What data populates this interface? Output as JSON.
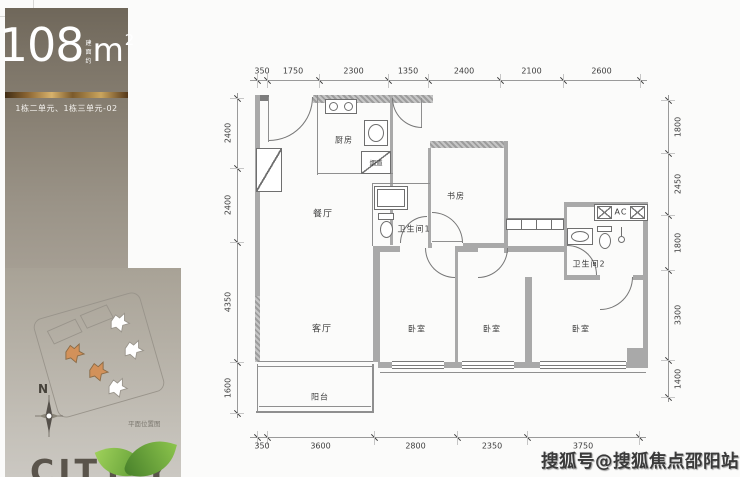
{
  "sidebar": {
    "area_number": "108",
    "area_prefix": "建面约",
    "area_unit": "m",
    "area_sup": "2",
    "unit_text": "1栋二单元、1栋三单元-02",
    "compass_label": "N",
    "site_caption": "平面位置图",
    "brand_text": "CITY Y",
    "accent_gold": "#caa55e",
    "leaf_green": "#6aa84f"
  },
  "watermark": {
    "text": "搜狐号@搜狐焦点邵阳站"
  },
  "floorplan": {
    "rooms": [
      [
        "厨房",
        344,
        140,
        2,
        "room-label-kitchen"
      ],
      [
        "烟道",
        376,
        162,
        3,
        "room-label-flue"
      ],
      [
        "餐厅",
        323,
        213,
        1,
        "room-label-dining"
      ],
      [
        "卫生间1",
        414,
        229,
        2,
        "room-label-bathroom-1"
      ],
      [
        "书房",
        456,
        196,
        2,
        "room-label-study"
      ],
      [
        "AC",
        621,
        212,
        2,
        "room-label-ac"
      ],
      [
        "卫生间2",
        589,
        264,
        2,
        "room-label-bathroom-2"
      ],
      [
        "客厅",
        322,
        328,
        1,
        "room-label-living"
      ],
      [
        "卧室",
        417,
        329,
        2,
        "room-label-bedroom-1"
      ],
      [
        "卧室",
        492,
        329,
        2,
        "room-label-bedroom-2"
      ],
      [
        "卧室",
        581,
        329,
        2,
        "room-label-bedroom-3"
      ],
      [
        "阳台",
        320,
        397,
        2,
        "room-label-balcony"
      ]
    ],
    "walls": [
      [
        255,
        95,
        14,
        6,
        "d"
      ],
      [
        313,
        95,
        120,
        8,
        "h"
      ],
      [
        390,
        95,
        3,
        150,
        "g"
      ],
      [
        430,
        141,
        77,
        7,
        "h"
      ],
      [
        428,
        148,
        3,
        100,
        "g"
      ],
      [
        504,
        141,
        4,
        112,
        "g"
      ],
      [
        565,
        202,
        83,
        5,
        "g"
      ],
      [
        564,
        202,
        3,
        75,
        "g"
      ],
      [
        643,
        202,
        5,
        162,
        "g"
      ],
      [
        255,
        95,
        5,
        201,
        "g"
      ],
      [
        255,
        296,
        5,
        66,
        "h"
      ],
      [
        373,
        246,
        27,
        6,
        "g"
      ],
      [
        455,
        246,
        23,
        6,
        "g"
      ],
      [
        508,
        246,
        56,
        6,
        "g"
      ],
      [
        564,
        275,
        36,
        5,
        "g"
      ],
      [
        633,
        275,
        15,
        5,
        "g"
      ],
      [
        428,
        243,
        4,
        5,
        "g"
      ],
      [
        463,
        243,
        44,
        5,
        "g"
      ],
      [
        373,
        250,
        7,
        112,
        "g"
      ],
      [
        455,
        250,
        3,
        112,
        "g"
      ],
      [
        525,
        277,
        7,
        85,
        "g"
      ],
      [
        378,
        362,
        270,
        6,
        "g"
      ],
      [
        627,
        348,
        16,
        16,
        "g"
      ]
    ],
    "lines": [
      [
        317,
        95,
        1,
        80
      ],
      [
        317,
        173,
        76,
        1
      ],
      [
        372,
        183,
        58,
        1
      ],
      [
        372,
        183,
        1,
        63
      ],
      [
        506,
        218,
        58,
        1
      ],
      [
        258,
        361,
        115,
        1
      ],
      [
        258,
        366,
        115,
        1
      ],
      [
        257,
        364,
        1,
        49
      ],
      [
        372,
        364,
        2,
        49
      ],
      [
        256,
        411,
        118,
        2
      ],
      [
        259,
        406,
        112,
        1
      ],
      [
        380,
        372,
        266,
        1
      ],
      [
        268,
        97,
        1,
        45
      ],
      [
        421,
        98,
        1,
        30
      ],
      [
        432,
        241,
        30,
        1
      ]
    ],
    "windows": [
      [
        392,
        361,
        52,
        8
      ],
      [
        462,
        361,
        52,
        8
      ],
      [
        540,
        361,
        86,
        8
      ]
    ],
    "fixtures": [
      [
        "box",
        325,
        99,
        32,
        15,
        "stove"
      ],
      [
        "circ",
        329,
        102,
        9,
        9,
        "stove-burner"
      ],
      [
        "circ",
        344,
        102,
        9,
        9,
        "stove-burner"
      ],
      [
        "box",
        364,
        120,
        24,
        26,
        "kitchen-sink"
      ],
      [
        "oval",
        368,
        124,
        16,
        18,
        "kitchen-sink-basin"
      ],
      [
        "box",
        361,
        151,
        30,
        23,
        "flue-box"
      ],
      [
        "diag",
        361,
        151,
        30,
        23,
        "flue-diagonal"
      ],
      [
        "box",
        256,
        148,
        26,
        44,
        "entry-cabinet"
      ],
      [
        "diag",
        256,
        148,
        26,
        44,
        "entry-cabinet-diagonal"
      ],
      [
        "box",
        374,
        186,
        34,
        24,
        "bathtub"
      ],
      [
        "box",
        377,
        189,
        28,
        18,
        "bathtub-inner"
      ],
      [
        "box",
        378,
        213,
        16,
        7,
        "toilet-1-tank"
      ],
      [
        "oval",
        380,
        221,
        13,
        17,
        "toilet-1-bowl"
      ],
      [
        "box",
        506,
        219,
        58,
        11,
        "hall-closet"
      ],
      [
        "vl",
        521,
        219,
        1,
        11,
        "closet-divider"
      ],
      [
        "vl",
        536,
        219,
        1,
        11,
        "closet-divider"
      ],
      [
        "vl",
        551,
        219,
        1,
        11,
        "closet-divider"
      ],
      [
        "box",
        567,
        228,
        26,
        17,
        "vanity"
      ],
      [
        "oval",
        571,
        231,
        18,
        11,
        "vanity-basin"
      ],
      [
        "box",
        597,
        226,
        15,
        6,
        "toilet-2-tank"
      ],
      [
        "oval",
        599,
        233,
        12,
        16,
        "toilet-2-bowl"
      ],
      [
        "circ",
        618,
        236,
        7,
        7,
        "shower-head"
      ],
      [
        "vl",
        621,
        227,
        1,
        9,
        "shower-arm"
      ],
      [
        "box",
        594,
        204,
        54,
        17,
        "ac-box"
      ],
      [
        "xbox",
        597,
        206,
        15,
        13,
        "ac-hatch"
      ],
      [
        "xbox",
        630,
        206,
        15,
        13,
        "ac-hatch"
      ]
    ],
    "arcs": [
      [
        269,
        97,
        44,
        "br",
        "entry-door-arc"
      ],
      [
        392,
        98,
        30,
        "bl",
        "kitchen-door-arc"
      ],
      [
        432,
        212,
        31,
        "tr",
        "study-door-arc"
      ],
      [
        400,
        216,
        27,
        "tl",
        "bathroom-1-door-arc"
      ],
      [
        425,
        248,
        30,
        "bl",
        "bedroom-1-door-arc"
      ],
      [
        478,
        248,
        30,
        "br",
        "bedroom-2-door-arc"
      ],
      [
        600,
        277,
        33,
        "br",
        "bedroom-3-door-arc"
      ],
      [
        567,
        245,
        30,
        "tr",
        "bathroom-2-door-arc"
      ]
    ],
    "dims": {
      "top": {
        "line": [
          250,
          80,
          397
        ],
        "ticks": [
          257,
          267,
          319,
          388,
          428,
          500,
          563,
          640
        ],
        "values": [
          "350",
          "1750",
          "2300",
          "1350",
          "2400",
          "2100",
          "2600"
        ]
      },
      "bottom": {
        "line": [
          250,
          437,
          396
        ],
        "ticks": [
          257,
          267,
          374,
          457,
          527,
          639
        ],
        "values": [
          "350",
          "3600",
          "2800",
          "2350",
          "3750"
        ]
      },
      "left": {
        "line": [
          237,
          93,
          325
        ],
        "ticks": [
          98,
          168,
          242,
          362,
          413
        ],
        "values": [
          "2400",
          "2400",
          "4350",
          "1600"
        ]
      },
      "right": {
        "line": [
          668,
          95,
          307
        ],
        "ticks": [
          100,
          153,
          215,
          270,
          360,
          397
        ],
        "values": [
          "1800",
          "2450",
          "1800",
          "3300",
          "1400"
        ]
      }
    }
  }
}
